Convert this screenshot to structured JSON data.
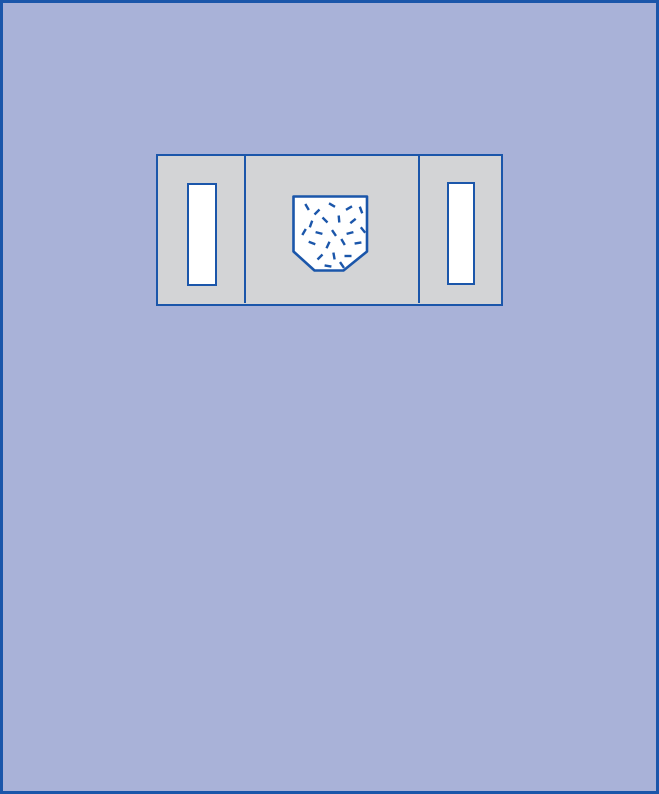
{
  "palette": {
    "background": "#a9b2d8",
    "outline": "#1b56aa",
    "panel_fill": "#d3d4d6",
    "window_fill": "#ffffff"
  },
  "diagram": {
    "dash_length": 7,
    "speckle_dashes": [
      {
        "x": 304,
        "y": 204,
        "angle": 60
      },
      {
        "x": 314,
        "y": 209,
        "angle": -45
      },
      {
        "x": 329,
        "y": 202,
        "angle": 30
      },
      {
        "x": 346,
        "y": 205,
        "angle": -30
      },
      {
        "x": 358,
        "y": 207,
        "angle": 70
      },
      {
        "x": 308,
        "y": 221,
        "angle": -70
      },
      {
        "x": 322,
        "y": 217,
        "angle": 45
      },
      {
        "x": 336,
        "y": 216,
        "angle": 85
      },
      {
        "x": 350,
        "y": 218,
        "angle": -40
      },
      {
        "x": 301,
        "y": 229,
        "angle": -60
      },
      {
        "x": 316,
        "y": 230,
        "angle": 15
      },
      {
        "x": 331,
        "y": 230,
        "angle": 55
      },
      {
        "x": 347,
        "y": 230,
        "angle": -15
      },
      {
        "x": 360,
        "y": 227,
        "angle": 50
      },
      {
        "x": 309,
        "y": 240,
        "angle": 20
      },
      {
        "x": 325,
        "y": 242,
        "angle": -65
      },
      {
        "x": 340,
        "y": 239,
        "angle": 60
      },
      {
        "x": 355,
        "y": 240,
        "angle": -10
      },
      {
        "x": 317,
        "y": 254,
        "angle": -45
      },
      {
        "x": 331,
        "y": 253,
        "angle": 80
      },
      {
        "x": 345,
        "y": 253,
        "angle": 0
      },
      {
        "x": 325,
        "y": 263,
        "angle": 10
      },
      {
        "x": 339,
        "y": 262,
        "angle": 55
      }
    ],
    "pouch_points": "290.5,193.5 364,193.5 364,248.5 340.5,267.5 311.5,267.5 290.5,248.5"
  }
}
